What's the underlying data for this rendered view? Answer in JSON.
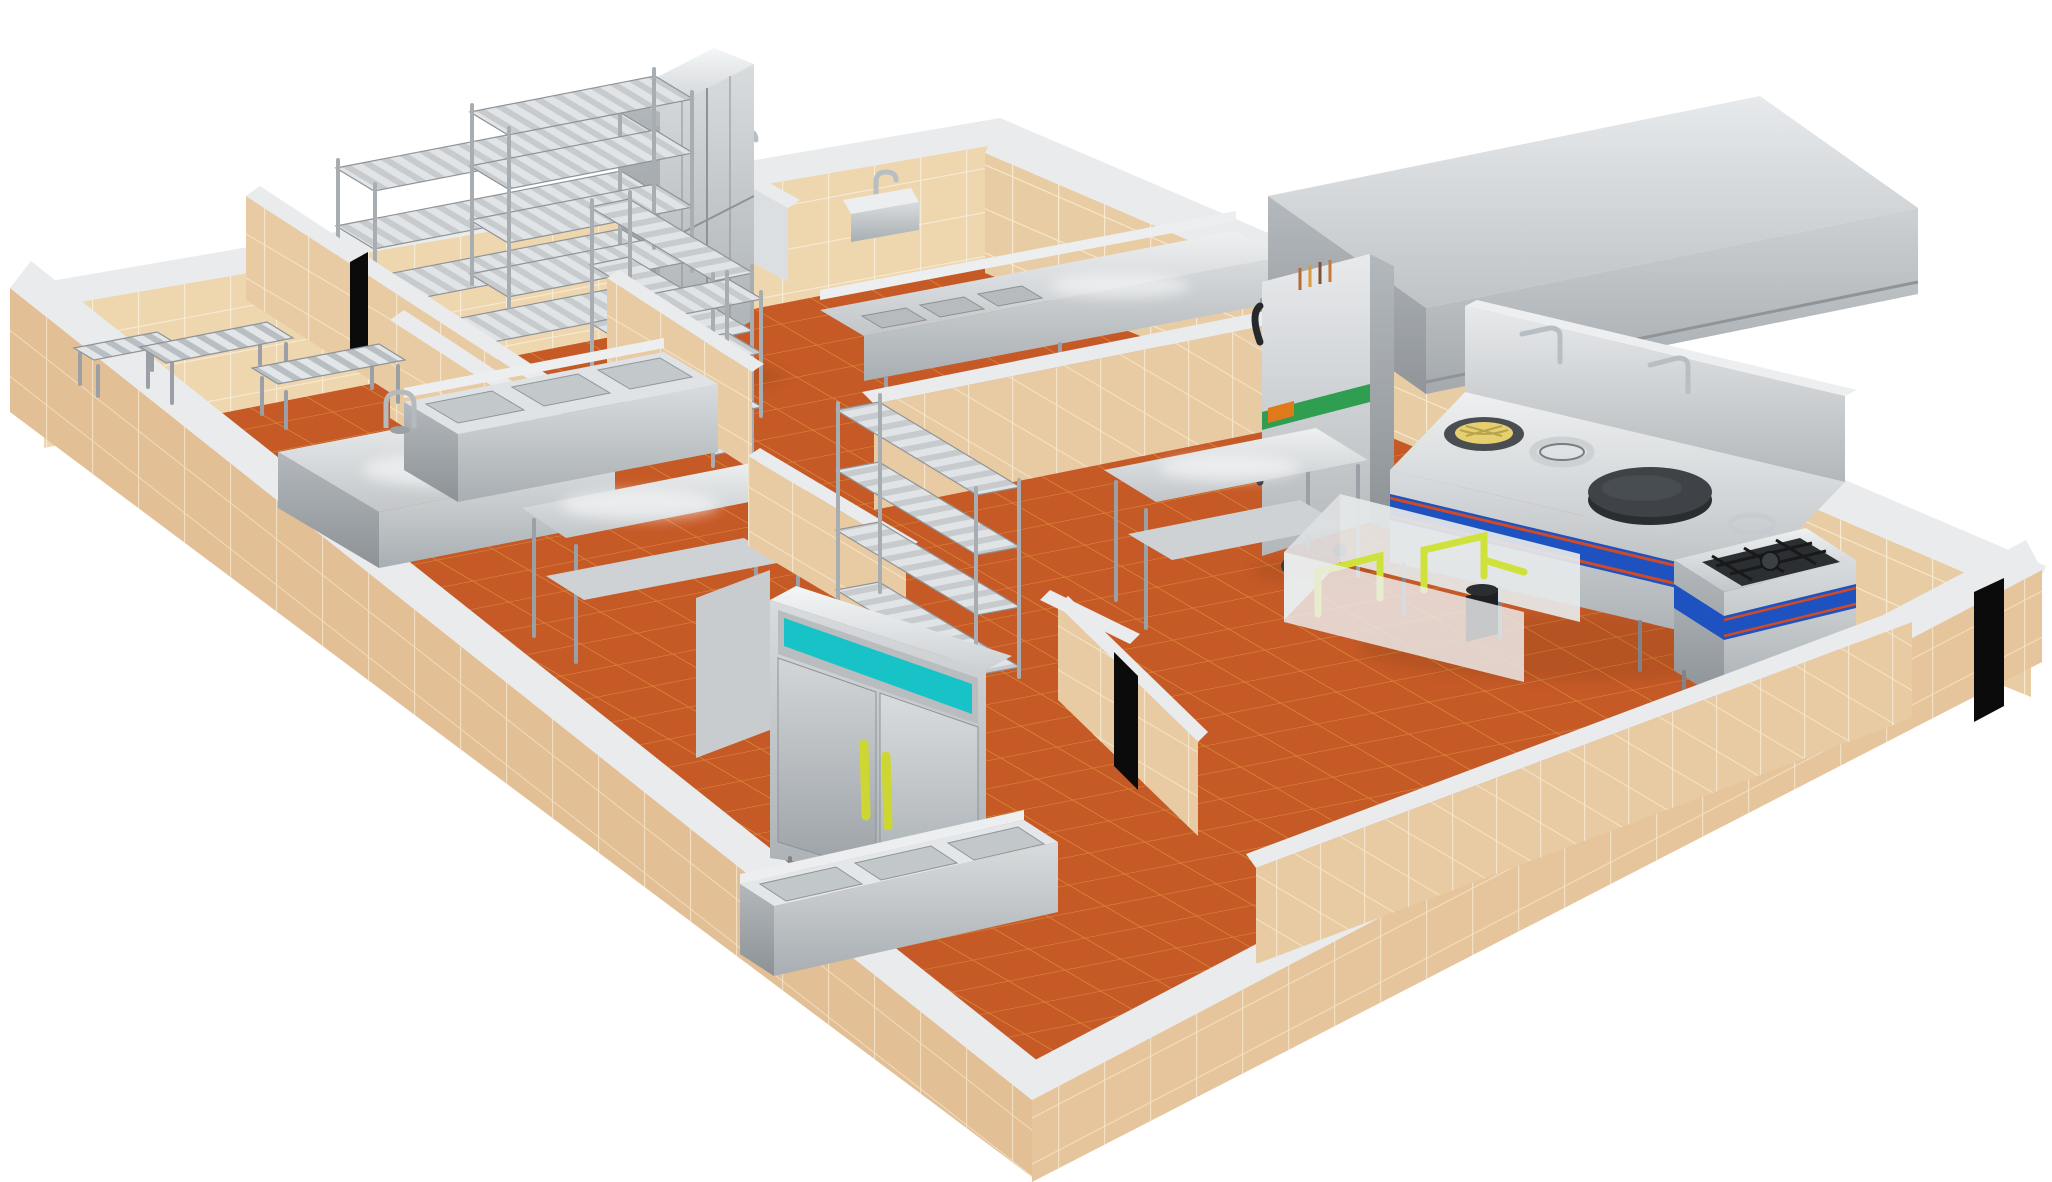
{
  "scene": {
    "kind": "3d-isometric-render",
    "subject": "commercial kitchen floor plan with stainless steel equipment"
  },
  "colors": {
    "background": "#ffffff",
    "floor": "#c65a27",
    "floor_grout": "#e29a3e",
    "wall_face_lit": "#eed6af",
    "wall_face_ne": "#e8cda4",
    "wall_face_partition": "#e8cba3",
    "wall_face_outer_sw": "#e3bf95",
    "wall_face_outer_se": "#e6c59c",
    "wall_cap": "#e9ebed",
    "steel_light": "#eceeef",
    "steel_mid": "#c3c7ca",
    "steel_dark": "#8f9498",
    "fridge_accent_cyan": "#17c3c6",
    "door_handle_yellow": "#cdd633",
    "range_band_blue": "#1d52c0",
    "range_stripe_red": "#cf4a26",
    "steamer_band_green": "#2f9e50",
    "steamer_label_orange": "#e0791a",
    "burner_yellow": "#e6cf6e",
    "griddle_plate_black": "#3f4347",
    "gas_pipe_yellow": "#cfe23c",
    "doorway_black": "#0b0b0b"
  },
  "equipment": [
    {
      "name": "dunnage-bench",
      "qty": 3
    },
    {
      "name": "wire-shelving-rack",
      "qty": 5
    },
    {
      "name": "tall-storage-cabinet",
      "qty": 1
    },
    {
      "name": "wall-hand-sink",
      "qty": 2
    },
    {
      "name": "three-compartment-sink",
      "qty": 3
    },
    {
      "name": "prep-counter",
      "qty": 2
    },
    {
      "name": "work-table-with-undershelf",
      "qty": 2
    },
    {
      "name": "double-door-refrigerator",
      "qty": 1
    },
    {
      "name": "steamer-cabinet",
      "qty": 1
    },
    {
      "name": "exhaust-hood",
      "qty": 1
    },
    {
      "name": "wok-range",
      "qty": 1
    },
    {
      "name": "stock-pot-stove",
      "qty": 1
    },
    {
      "name": "pot-wash-cart",
      "qty": 1
    },
    {
      "name": "floor-faucet",
      "qty": 1
    },
    {
      "name": "doorway-opening",
      "qty": 3
    }
  ]
}
